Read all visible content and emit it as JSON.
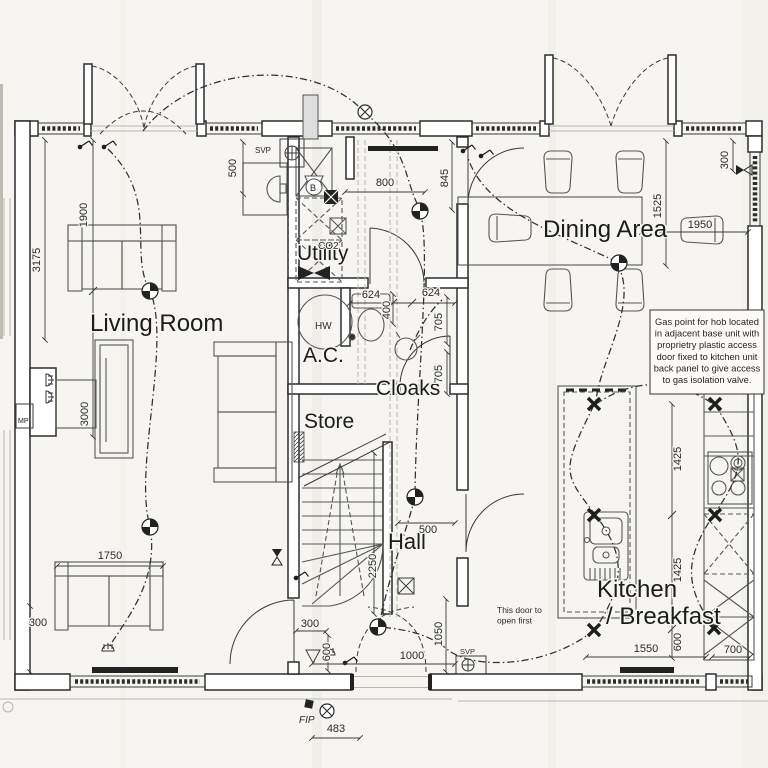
{
  "colors": {
    "paper": "#f6f5f1",
    "ink": "#2d2d2d"
  },
  "rooms": [
    {
      "label": "Living Room",
      "x": 90,
      "y": 331,
      "s": 24
    },
    {
      "label": "Utility",
      "x": 297,
      "y": 260,
      "s": 21
    },
    {
      "label": "A.C.",
      "x": 303,
      "y": 362,
      "s": 21
    },
    {
      "label": "Cloaks",
      "x": 376,
      "y": 395,
      "s": 21
    },
    {
      "label": "Store",
      "x": 304,
      "y": 428,
      "s": 21
    },
    {
      "label": "Hall",
      "x": 388,
      "y": 549,
      "s": 22
    },
    {
      "label": "Dining Area",
      "x": 543,
      "y": 237,
      "s": 24
    },
    {
      "label": "Kitchen",
      "x": 597,
      "y": 597,
      "s": 24
    },
    {
      "label": "/ Breakfast",
      "x": 606,
      "y": 624,
      "s": 24
    }
  ],
  "dimensions": [
    {
      "t": "500",
      "x": 236,
      "y": 168,
      "rot": 1
    },
    {
      "t": "1900",
      "x": 87,
      "y": 215,
      "rot": 1
    },
    {
      "t": "3175",
      "x": 40,
      "y": 260,
      "rot": 1
    },
    {
      "t": "3000",
      "x": 88,
      "y": 414,
      "rot": 1
    },
    {
      "t": "1750",
      "x": 110,
      "y": 559,
      "rot": 0
    },
    {
      "t": "300",
      "x": 38,
      "y": 626,
      "rot": 0
    },
    {
      "t": "800",
      "x": 385,
      "y": 186,
      "rot": 0
    },
    {
      "t": "845",
      "x": 448,
      "y": 178,
      "rot": 1
    },
    {
      "t": "624",
      "x": 371,
      "y": 298,
      "rot": 0
    },
    {
      "t": "624",
      "x": 431,
      "y": 296,
      "rot": 0
    },
    {
      "t": "400",
      "x": 390,
      "y": 310,
      "rot": 1
    },
    {
      "t": "705",
      "x": 442,
      "y": 322,
      "rot": 1
    },
    {
      "t": "705",
      "x": 442,
      "y": 374,
      "rot": 1
    },
    {
      "t": "300",
      "x": 728,
      "y": 160,
      "rot": 1
    },
    {
      "t": "1525",
      "x": 661,
      "y": 206,
      "rot": 1
    },
    {
      "t": "1950",
      "x": 700,
      "y": 228,
      "rot": 0
    },
    {
      "t": "1425",
      "x": 681,
      "y": 459,
      "rot": 1
    },
    {
      "t": "1425",
      "x": 681,
      "y": 570,
      "rot": 1
    },
    {
      "t": "600",
      "x": 681,
      "y": 642,
      "rot": 1
    },
    {
      "t": "1550",
      "x": 646,
      "y": 652,
      "rot": 0
    },
    {
      "t": "700",
      "x": 733,
      "y": 653,
      "rot": 0
    },
    {
      "t": "500",
      "x": 428,
      "y": 533,
      "rot": 0
    },
    {
      "t": "2250",
      "x": 376,
      "y": 566,
      "rot": 1
    },
    {
      "t": "1050",
      "x": 442,
      "y": 634,
      "rot": 1
    },
    {
      "t": "1000",
      "x": 412,
      "y": 659,
      "rot": 0
    },
    {
      "t": "300",
      "x": 310,
      "y": 627,
      "rot": 0
    },
    {
      "t": "600",
      "x": 330,
      "y": 652,
      "rot": 1
    },
    {
      "t": "483",
      "x": 336,
      "y": 732,
      "rot": 0
    }
  ],
  "small_labels": [
    {
      "t": "SVP",
      "x": 255,
      "y": 153,
      "s": 8
    },
    {
      "t": "SVP",
      "x": 460,
      "y": 654,
      "s": 7.5
    },
    {
      "t": "FIP",
      "x": 299,
      "y": 723,
      "s": 10,
      "italic": 1
    },
    {
      "t": "CO2",
      "x": 318,
      "y": 249,
      "s": 10
    },
    {
      "t": "B",
      "x": 310,
      "y": 191,
      "s": 9
    },
    {
      "t": "HW",
      "x": 315,
      "y": 329,
      "s": 10
    },
    {
      "t": "MP",
      "x": 18,
      "y": 423,
      "s": 7
    }
  ],
  "gas_note": {
    "lines": [
      "Gas point for hob located",
      "in adjacent base unit with",
      "proprietry plastic access",
      "door fixed to kitchen unit",
      "back panel to give access",
      "to gas isolation valve."
    ]
  },
  "door_note": {
    "lines": [
      "This door to",
      "open first"
    ]
  }
}
